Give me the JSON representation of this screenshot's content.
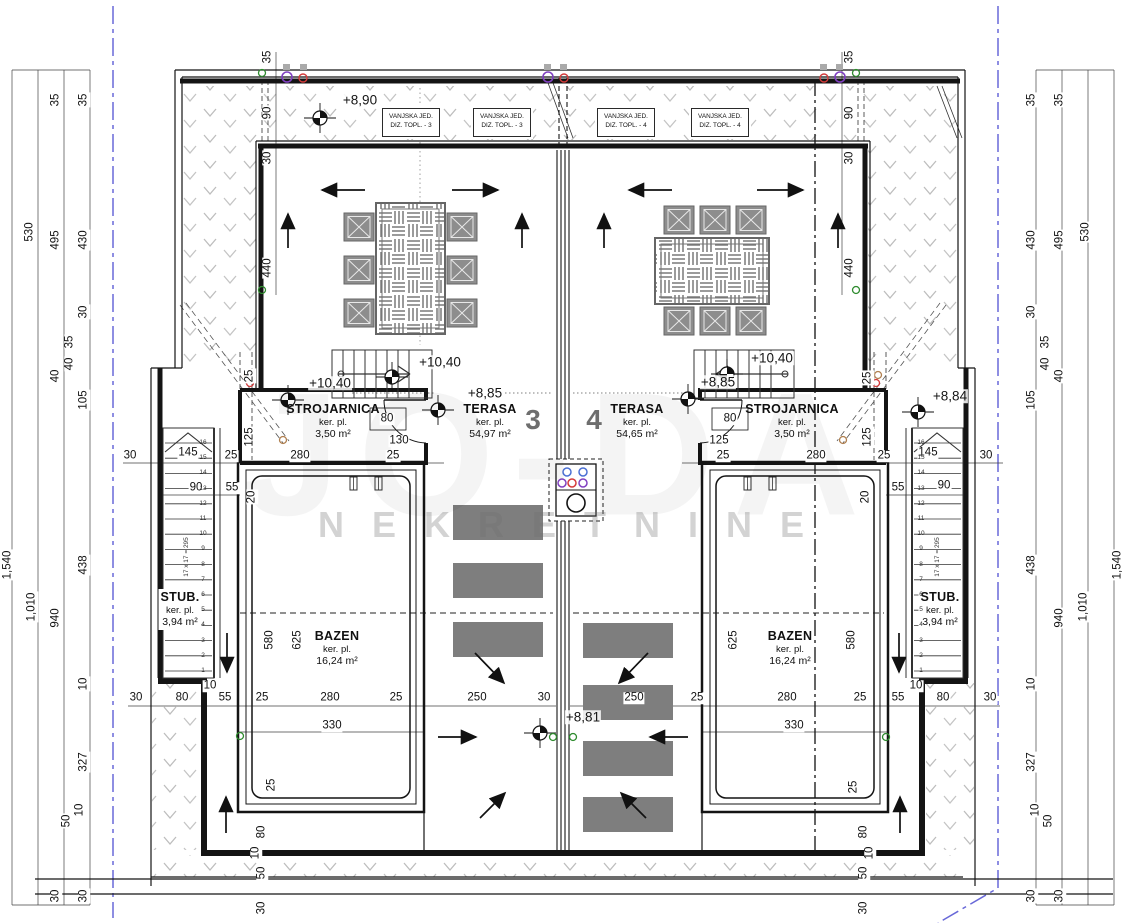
{
  "watermark": {
    "brand": "JO-DA",
    "sub": "NEKRETNINE"
  },
  "rooms": {
    "strojarnica_left": {
      "title": "STROJARNICA",
      "sub": "ker. pl.",
      "area": "3,50 m²"
    },
    "strojarnica_right": {
      "title": "STROJARNICA",
      "sub": "ker. pl.",
      "area": "3,50 m²"
    },
    "terasa_left": {
      "title": "TERASA",
      "sub": "ker. pl.",
      "area": "54,97 m²"
    },
    "terasa_right": {
      "title": "TERASA",
      "sub": "ker. pl.",
      "area": "54,65 m²"
    },
    "bazen_left": {
      "title": "BAZEN",
      "sub": "ker. pl.",
      "area": "16,24 m²"
    },
    "bazen_right": {
      "title": "BAZEN",
      "sub": "ker. pl.",
      "area": "16,24 m²"
    },
    "stub_left": {
      "title": "STUB.",
      "sub": "ker. pl.",
      "area": "3,94 m²"
    },
    "stub_right": {
      "title": "STUB.",
      "sub": "ker. pl.",
      "area": "3,94 m²"
    },
    "unit_left_number": "3",
    "unit_right_number": "4"
  },
  "hvac_units": [
    {
      "line1": "VANJSKA JED.",
      "line2": "DIZ. TOPL. - 3"
    },
    {
      "line1": "VANJSKA JED.",
      "line2": "DIZ. TOPL. - 3"
    },
    {
      "line1": "VANJSKA JED.",
      "line2": "DIZ. TOPL. - 4"
    },
    {
      "line1": "VANJSKA JED.",
      "line2": "DIZ. TOPL. - 4"
    }
  ],
  "levels": [
    {
      "t": "+8,90",
      "x": 360,
      "y": 100
    },
    {
      "t": "+10,40",
      "x": 440,
      "y": 362
    },
    {
      "t": "+10,40",
      "x": 330,
      "y": 383
    },
    {
      "t": "+8,85",
      "x": 485,
      "y": 393
    },
    {
      "t": "+10,40",
      "x": 772,
      "y": 358
    },
    {
      "t": "+8,85",
      "x": 718,
      "y": 382
    },
    {
      "t": "+8,84",
      "x": 950,
      "y": 396
    },
    {
      "t": "+8,81",
      "x": 583,
      "y": 717
    }
  ],
  "stairs": {
    "formula": "17 x 17 = 295",
    "numbers": [
      16,
      15,
      14,
      13,
      12,
      11,
      10,
      9,
      8,
      7,
      6,
      5,
      4,
      3,
      2,
      1
    ]
  },
  "dim_labels": [
    {
      "t": "1,540",
      "x": 8,
      "y": 565,
      "r": "v"
    },
    {
      "t": "530",
      "x": 30,
      "y": 232,
      "r": "v"
    },
    {
      "t": "1,010",
      "x": 32,
      "y": 607,
      "r": "v"
    },
    {
      "t": "35",
      "x": 56,
      "y": 100,
      "r": "v"
    },
    {
      "t": "495",
      "x": 56,
      "y": 240,
      "r": "v"
    },
    {
      "t": "40",
      "x": 56,
      "y": 376,
      "r": "v"
    },
    {
      "t": "940",
      "x": 56,
      "y": 618,
      "r": "v"
    },
    {
      "t": "30",
      "x": 56,
      "y": 896,
      "r": "v"
    },
    {
      "t": "35",
      "x": 84,
      "y": 100,
      "r": "v"
    },
    {
      "t": "430",
      "x": 84,
      "y": 240,
      "r": "v"
    },
    {
      "t": "30",
      "x": 84,
      "y": 312,
      "r": "v"
    },
    {
      "t": "35",
      "x": 70,
      "y": 342,
      "r": "v"
    },
    {
      "t": "40",
      "x": 70,
      "y": 364,
      "r": "v"
    },
    {
      "t": "105",
      "x": 84,
      "y": 400,
      "r": "v"
    },
    {
      "t": "438",
      "x": 84,
      "y": 565,
      "r": "v"
    },
    {
      "t": "10",
      "x": 84,
      "y": 684,
      "r": "v"
    },
    {
      "t": "327",
      "x": 84,
      "y": 762,
      "r": "v"
    },
    {
      "t": "10",
      "x": 80,
      "y": 810,
      "r": "v"
    },
    {
      "t": "50",
      "x": 67,
      "y": 821,
      "r": "v"
    },
    {
      "t": "30",
      "x": 84,
      "y": 896,
      "r": "v"
    },
    {
      "t": "1,540",
      "x": 1118,
      "y": 565,
      "r": "v"
    },
    {
      "t": "530",
      "x": 1086,
      "y": 232,
      "r": "v"
    },
    {
      "t": "1,010",
      "x": 1084,
      "y": 607,
      "r": "v"
    },
    {
      "t": "35",
      "x": 1060,
      "y": 100,
      "r": "v"
    },
    {
      "t": "495",
      "x": 1060,
      "y": 240,
      "r": "v"
    },
    {
      "t": "40",
      "x": 1060,
      "y": 376,
      "r": "v"
    },
    {
      "t": "940",
      "x": 1060,
      "y": 618,
      "r": "v"
    },
    {
      "t": "30",
      "x": 1060,
      "y": 896,
      "r": "v"
    },
    {
      "t": "35",
      "x": 1032,
      "y": 100,
      "r": "v"
    },
    {
      "t": "430",
      "x": 1032,
      "y": 240,
      "r": "v"
    },
    {
      "t": "30",
      "x": 1032,
      "y": 312,
      "r": "v"
    },
    {
      "t": "35",
      "x": 1046,
      "y": 342,
      "r": "v"
    },
    {
      "t": "40",
      "x": 1046,
      "y": 364,
      "r": "v"
    },
    {
      "t": "105",
      "x": 1032,
      "y": 400,
      "r": "v"
    },
    {
      "t": "438",
      "x": 1032,
      "y": 565,
      "r": "v"
    },
    {
      "t": "10",
      "x": 1032,
      "y": 684,
      "r": "v"
    },
    {
      "t": "327",
      "x": 1032,
      "y": 762,
      "r": "v"
    },
    {
      "t": "10",
      "x": 1036,
      "y": 810,
      "r": "v"
    },
    {
      "t": "50",
      "x": 1049,
      "y": 821,
      "r": "v"
    },
    {
      "t": "30",
      "x": 1032,
      "y": 896,
      "r": "v"
    },
    {
      "t": "35",
      "x": 268,
      "y": 57,
      "r": "v"
    },
    {
      "t": "90",
      "x": 268,
      "y": 113,
      "r": "v"
    },
    {
      "t": "30",
      "x": 268,
      "y": 158,
      "r": "v"
    },
    {
      "t": "440",
      "x": 268,
      "y": 268,
      "r": "v"
    },
    {
      "t": "35",
      "x": 850,
      "y": 57,
      "r": "v"
    },
    {
      "t": "90",
      "x": 850,
      "y": 113,
      "r": "v"
    },
    {
      "t": "30",
      "x": 850,
      "y": 158,
      "r": "v"
    },
    {
      "t": "440",
      "x": 850,
      "y": 268,
      "r": "v"
    },
    {
      "t": "25",
      "x": 250,
      "y": 376,
      "r": "v"
    },
    {
      "t": "125",
      "x": 250,
      "y": 437,
      "r": "v"
    },
    {
      "t": "25",
      "x": 868,
      "y": 378,
      "r": "v"
    },
    {
      "t": "125",
      "x": 868,
      "y": 437,
      "r": "v"
    },
    {
      "t": "20",
      "x": 252,
      "y": 497,
      "r": "v"
    },
    {
      "t": "580",
      "x": 270,
      "y": 640,
      "r": "v"
    },
    {
      "t": "625",
      "x": 298,
      "y": 640,
      "r": "v"
    },
    {
      "t": "625",
      "x": 734,
      "y": 640,
      "r": "v"
    },
    {
      "t": "580",
      "x": 852,
      "y": 640,
      "r": "v"
    },
    {
      "t": "20",
      "x": 866,
      "y": 497,
      "r": "v"
    },
    {
      "t": "280",
      "x": 300,
      "y": 456,
      "r": "h"
    },
    {
      "t": "25",
      "x": 393,
      "y": 456,
      "r": "h"
    },
    {
      "t": "130",
      "x": 399,
      "y": 441,
      "r": "h"
    },
    {
      "t": "80",
      "x": 387,
      "y": 419,
      "r": "h"
    },
    {
      "t": "280",
      "x": 816,
      "y": 456,
      "r": "h"
    },
    {
      "t": "25",
      "x": 723,
      "y": 456,
      "r": "h"
    },
    {
      "t": "125",
      "x": 719,
      "y": 441,
      "r": "h"
    },
    {
      "t": "80",
      "x": 730,
      "y": 419,
      "r": "h"
    },
    {
      "t": "30",
      "x": 130,
      "y": 456,
      "r": "h"
    },
    {
      "t": "145",
      "x": 188,
      "y": 453,
      "r": "h"
    },
    {
      "t": "25",
      "x": 231,
      "y": 456,
      "r": "h"
    },
    {
      "t": "90",
      "x": 196,
      "y": 488,
      "r": "h"
    },
    {
      "t": "55",
      "x": 232,
      "y": 488,
      "r": "h"
    },
    {
      "t": "25",
      "x": 884,
      "y": 456,
      "r": "h"
    },
    {
      "t": "145",
      "x": 928,
      "y": 453,
      "r": "h"
    },
    {
      "t": "30",
      "x": 986,
      "y": 456,
      "r": "h"
    },
    {
      "t": "55",
      "x": 898,
      "y": 488,
      "r": "h"
    },
    {
      "t": "90",
      "x": 944,
      "y": 486,
      "r": "h"
    },
    {
      "t": "30",
      "x": 136,
      "y": 698,
      "r": "h"
    },
    {
      "t": "80",
      "x": 182,
      "y": 698,
      "r": "h"
    },
    {
      "t": "55",
      "x": 225,
      "y": 698,
      "r": "h"
    },
    {
      "t": "25",
      "x": 262,
      "y": 698,
      "r": "h"
    },
    {
      "t": "280",
      "x": 330,
      "y": 698,
      "r": "h"
    },
    {
      "t": "25",
      "x": 396,
      "y": 698,
      "r": "h"
    },
    {
      "t": "250",
      "x": 477,
      "y": 698,
      "r": "h"
    },
    {
      "t": "30",
      "x": 544,
      "y": 698,
      "r": "h"
    },
    {
      "t": "330",
      "x": 332,
      "y": 726,
      "r": "h"
    },
    {
      "t": "250",
      "x": 634,
      "y": 698,
      "r": "h"
    },
    {
      "t": "25",
      "x": 697,
      "y": 698,
      "r": "h"
    },
    {
      "t": "280",
      "x": 787,
      "y": 698,
      "r": "h"
    },
    {
      "t": "25",
      "x": 860,
      "y": 698,
      "r": "h"
    },
    {
      "t": "55",
      "x": 898,
      "y": 698,
      "r": "h"
    },
    {
      "t": "80",
      "x": 943,
      "y": 698,
      "r": "h"
    },
    {
      "t": "30",
      "x": 990,
      "y": 698,
      "r": "h"
    },
    {
      "t": "330",
      "x": 794,
      "y": 726,
      "r": "h"
    },
    {
      "t": "10",
      "x": 210,
      "y": 686,
      "r": "h"
    },
    {
      "t": "10",
      "x": 916,
      "y": 686,
      "r": "h"
    },
    {
      "t": "25",
      "x": 272,
      "y": 785,
      "r": "v"
    },
    {
      "t": "80",
      "x": 262,
      "y": 832,
      "r": "v"
    },
    {
      "t": "10",
      "x": 256,
      "y": 853,
      "r": "v"
    },
    {
      "t": "50",
      "x": 262,
      "y": 873,
      "r": "v"
    },
    {
      "t": "30",
      "x": 262,
      "y": 908,
      "r": "v"
    },
    {
      "t": "25",
      "x": 854,
      "y": 787,
      "r": "v"
    },
    {
      "t": "80",
      "x": 864,
      "y": 832,
      "r": "v"
    },
    {
      "t": "10",
      "x": 870,
      "y": 853,
      "r": "v"
    },
    {
      "t": "50",
      "x": 864,
      "y": 873,
      "r": "v"
    },
    {
      "t": "30",
      "x": 864,
      "y": 908,
      "r": "v"
    }
  ],
  "colors": {
    "boundary_blue": "#6868d8",
    "line_black": "#141414",
    "hatch_gray": "#bdbdbd",
    "furniture_gray": "#8d8d8d",
    "stone_gray": "#7e7e7e",
    "sym_red": "#d43a3a",
    "sym_blue": "#4a6fd4",
    "sym_purple": "#8040c0",
    "sym_green": "#2e8b2e"
  }
}
